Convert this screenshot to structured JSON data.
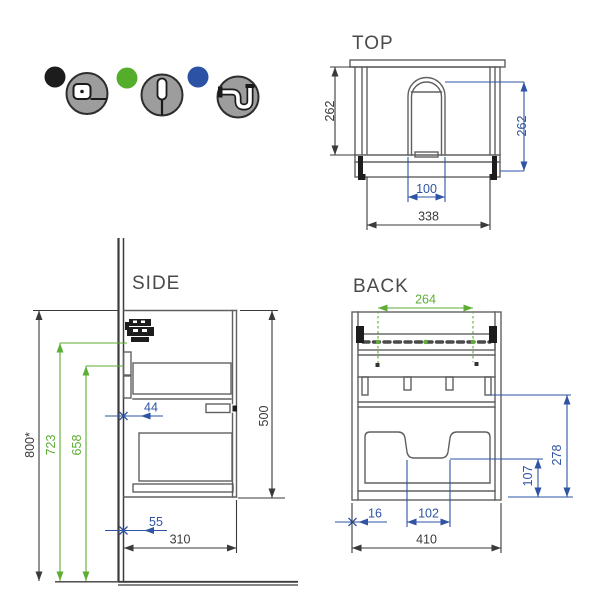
{
  "legend": {
    "items": [
      {
        "icon": "tape-measure-icon",
        "dot_color": "#1c1c1c"
      },
      {
        "icon": "screwdriver-icon",
        "dot_color": "#55ad2c"
      },
      {
        "icon": "siphon-icon",
        "dot_color": "#2b52a4"
      }
    ]
  },
  "views": {
    "top": {
      "title": "TOP",
      "dims": {
        "depth_left": "262",
        "depth_right": "262",
        "cutout_width": "100",
        "inner_width": "338"
      }
    },
    "side": {
      "title": "SIDE",
      "dims": {
        "floor_to_top": "800*",
        "floor_to_bracket": "723",
        "floor_to_plate": "658",
        "wall_to_drawer": "44",
        "wall_to_drain": "55",
        "depth": "310",
        "height": "500"
      }
    },
    "back": {
      "title": "BACK",
      "dims": {
        "bracket_spacing": "264",
        "drawer_zone_height": "278",
        "notch_to_bottom": "107",
        "edge_offset": "16",
        "notch_width": "102",
        "width": "410"
      }
    }
  },
  "colors": {
    "dimension_black": "#3a3a3a",
    "dimension_blue": "#2e54a3",
    "dimension_green": "#5eae35",
    "drawing_line": "#606060"
  }
}
